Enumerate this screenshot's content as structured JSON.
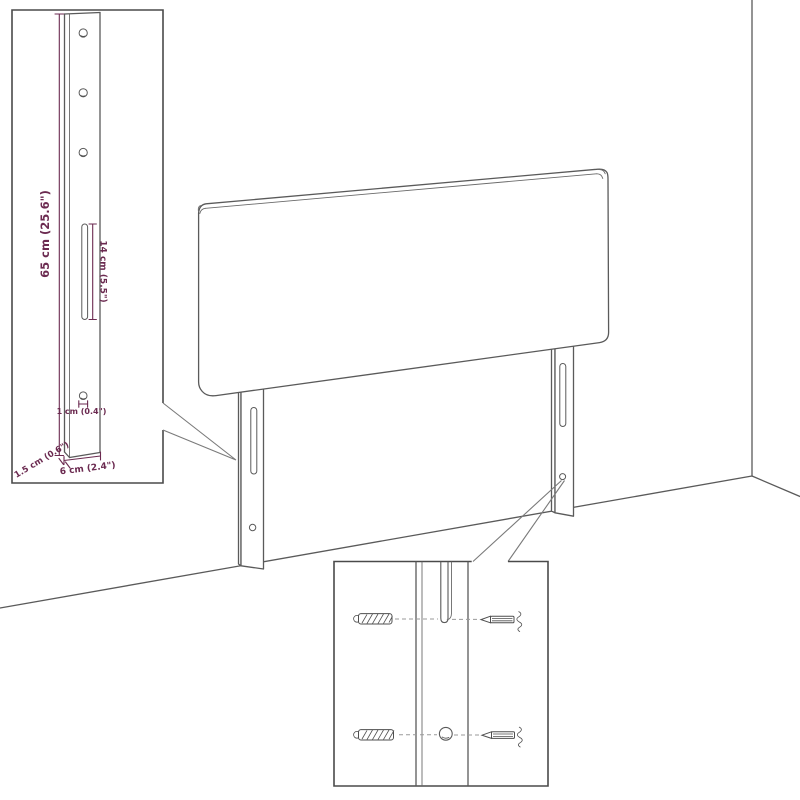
{
  "diagram": {
    "dimensions": {
      "leg_height": "65 cm (25.6\")",
      "slot_length": "14 cm (5.5\")",
      "hole_diameter": "1 cm (0.4\")",
      "leg_thickness": "1.5 cm (0.6\")",
      "leg_width": "6 cm (2.4\")"
    },
    "colors": {
      "line": "#5a5a5a",
      "dimension_accent": "#6b2a50",
      "box_border": "#4a4a4a",
      "dash": "#9a9a9a",
      "background": "#ffffff"
    }
  }
}
